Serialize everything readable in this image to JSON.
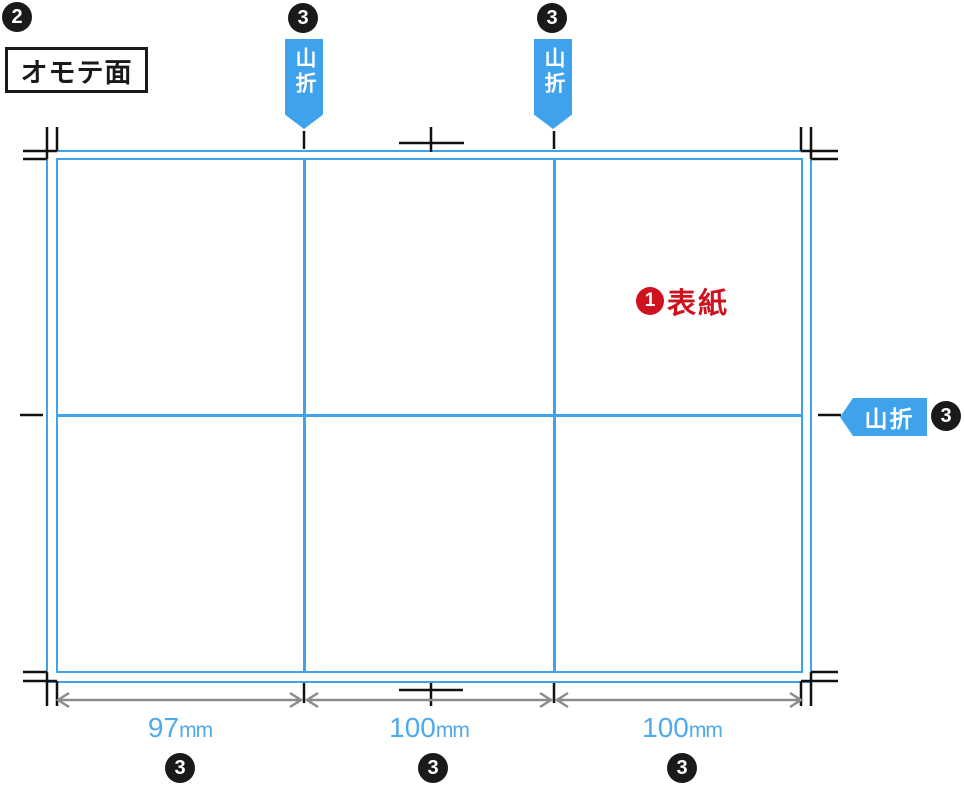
{
  "header": {
    "step_badge": "2",
    "side_label": "オモテ面"
  },
  "fold_flags": {
    "top_left": {
      "badge": "3",
      "label": "山折"
    },
    "top_right": {
      "badge": "3",
      "label": "山折"
    },
    "right": {
      "badge": "3",
      "label": "山折"
    }
  },
  "cover_label": {
    "badge": "1",
    "text": "表紙"
  },
  "dimensions": {
    "panels": [
      {
        "value": "97",
        "unit": "mm",
        "badge": "3"
      },
      {
        "value": "100",
        "unit": "mm",
        "badge": "3"
      },
      {
        "value": "100",
        "unit": "mm",
        "badge": "3"
      }
    ]
  },
  "colors": {
    "accent_blue": "#3FA2EC",
    "dimension_text_blue": "#4FA9ED",
    "cover_red": "#D0121F",
    "mark_black": "#111111",
    "dimension_gray": "#8C8C8C"
  }
}
